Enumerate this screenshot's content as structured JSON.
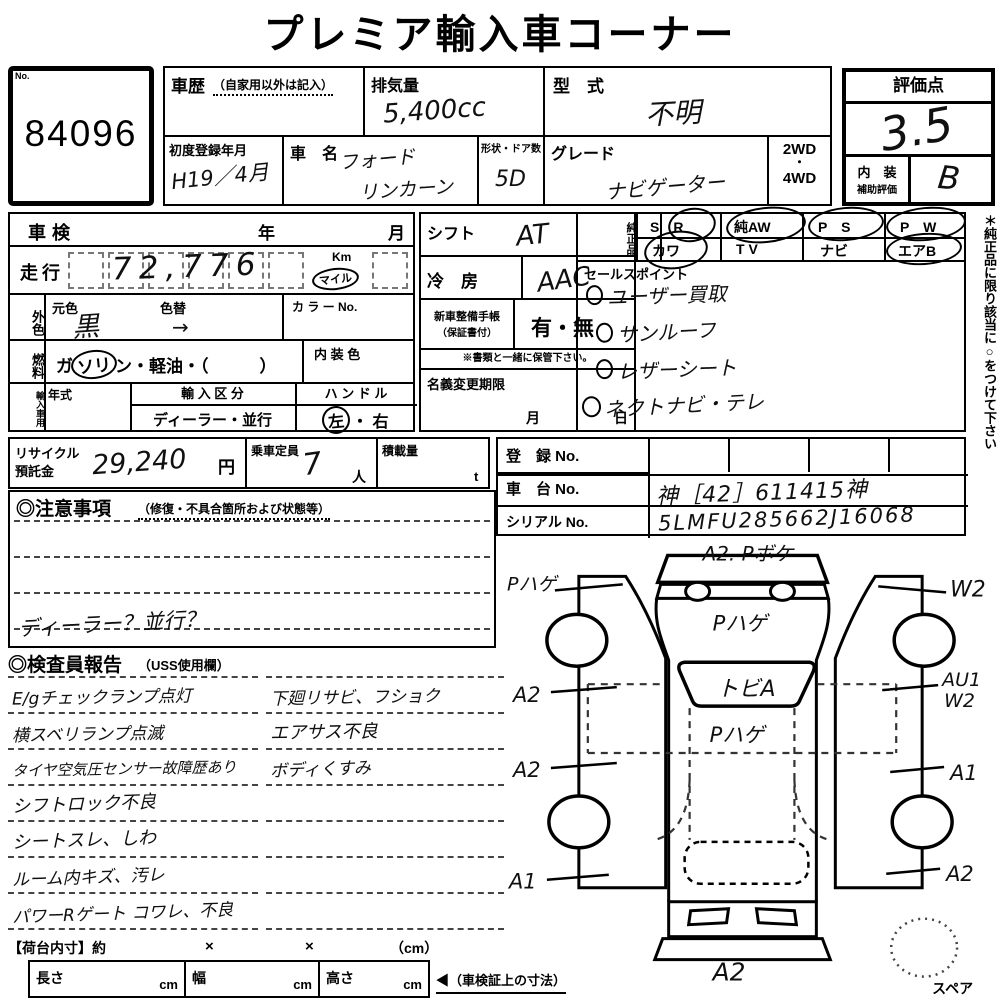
{
  "title": "プレミア輸入車コーナー",
  "lot": {
    "no_label": "No.",
    "number": "84096"
  },
  "header": {
    "history_label": "車歴",
    "history_note": "（自家用以外は記入）",
    "displacement_label": "排気量",
    "displacement_value": "5,400cc",
    "model_label": "型　式",
    "model_value": "不明",
    "first_reg_label": "初度登録年月",
    "first_reg_value": "H19／4月",
    "name_label": "車　名",
    "name_line1": "フォード",
    "name_line2": "リンカーン",
    "shape_label": "形状・ドア数",
    "shape_value": "5D",
    "grade_label": "グレード",
    "grade_value": "ナビゲーター",
    "drive_top": "2WD",
    "drive_dot": "・",
    "drive_bottom": "4WD",
    "score_label": "評価点",
    "score_value": "3.5",
    "interior_label_1": "内　装",
    "interior_label_2": "補助評価",
    "interior_value": "B"
  },
  "left": {
    "shaken_label": "車検",
    "year": "年",
    "month": "月",
    "mileage_label": "走行",
    "mileage_value": "72,776",
    "km": "Km",
    "mile": "マイル",
    "ext_color_label": "外色",
    "base_color_label": "元色",
    "base_color_value": "黒",
    "repaint_label": "色替",
    "repaint_arrow": "→",
    "color_no_label": "カ ラ ー No.",
    "fuel_label": "燃料",
    "fuel_pre": "ガ",
    "fuel_circle": "ソリ",
    "fuel_post": "ン・軽油・（　　　）",
    "int_color_label": "内 装 色",
    "import_label": "輸入車用",
    "year_type_label": "年式",
    "import_class_label": "輸 入 区 分",
    "import_class_value": "ディーラー・並行",
    "handle_label": "ハ ン ド ル",
    "handle_left": "左",
    "handle_mid": "・",
    "handle_right": "右"
  },
  "mid": {
    "shift_label": "シフト",
    "shift_value": "AT",
    "ac_label": "冷　房",
    "ac_value": "AAC",
    "book_label": "新車整備手帳",
    "book_sub": "（保証書付）",
    "book_value": "有・無",
    "keep_note": "※書類と一緒に保管下さい。",
    "transfer_label": "名義変更期限",
    "transfer_month": "月",
    "transfer_day": "日"
  },
  "genuine": {
    "label": "純正品",
    "r1c1": "S　R",
    "r1c2": "純AW",
    "r1c3": "P　S",
    "r1c4": "P　W",
    "r2c1": "カワ",
    "r2c2": "T V",
    "r2c3": "ナビ",
    "r2c4": "エアB",
    "side_note": "＊純正品に限り該当に○をつけて下さい"
  },
  "sales": {
    "label": "セールスポイント",
    "items": [
      "ユーザー買取",
      "サンルーフ",
      "レザーシート",
      "ネクトナビ・テレ"
    ]
  },
  "recycle": {
    "label1": "リサイクル",
    "label2": "預託金",
    "value": "29,240",
    "unit": "円",
    "capacity_label": "乗車定員",
    "capacity_value": "7",
    "capacity_unit": "人",
    "load_label": "積載量",
    "load_unit": "t"
  },
  "reg": {
    "reg_label": "登　録 No.",
    "chassis_label": "車　台 No.",
    "chassis_value": "神［42］611415神",
    "serial_label": "シリアル No.",
    "serial_value": "5LMFU285662J16068"
  },
  "attention": {
    "header": "◎注意事項",
    "sub": "（修復・不具合箇所および状態等）",
    "note": "ディーラー？並行？"
  },
  "inspector": {
    "header": "◎検査員報告",
    "sub": "（USS使用欄）",
    "rows": [
      {
        "left": "E/gチェックランプ点灯",
        "right": "下廻リサビ、フショク"
      },
      {
        "left": "横スベリランプ点滅",
        "right": "エアサス不良"
      },
      {
        "left": "タイヤ空気圧センサー故障歴あり",
        "right": "ボディくすみ"
      },
      {
        "left": "シフトロック不良",
        "right": ""
      },
      {
        "left": "シートスレ、しわ",
        "right": ""
      },
      {
        "left": "ルーム内キズ、汚レ",
        "right": ""
      },
      {
        "left": "パワーRゲート コワレ、不良",
        "right": ""
      }
    ]
  },
  "diagram": {
    "top": "A2. Pボケ",
    "left_top": "Pハゲ",
    "right_top": "W2",
    "hood": "Pハゲ",
    "windshield": "トビA",
    "roof": "Pハゲ",
    "left_mid1": "A2",
    "left_mid2": "A2",
    "left_bottom": "A1",
    "right_mid1": "AU1",
    "right_mid1b": "W2",
    "right_mid2": "A1",
    "right_bottom": "A2",
    "bottom": "A2",
    "spare": "スペア"
  },
  "bottom": {
    "bed_label": "【荷台内寸】約",
    "x1": "×",
    "x2": "×",
    "cm_note": "（cm）",
    "length_label": "長さ",
    "width_label": "幅",
    "height_label": "高さ",
    "cm": "cm",
    "arrow_note": "◀（車検証上の寸法）"
  }
}
